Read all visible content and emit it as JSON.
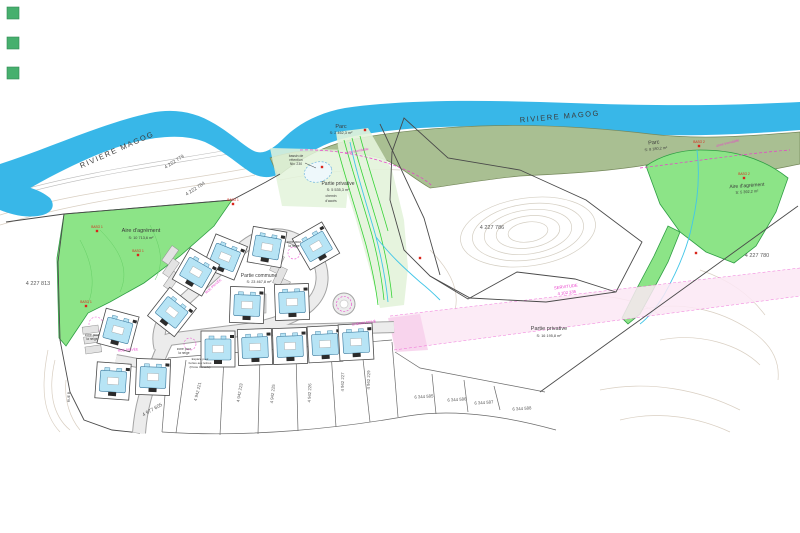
{
  "document_type": "cadastral site plan",
  "colors": {
    "river": "#38b7e8",
    "green": "#8ce487",
    "green_border": "#2f9e44",
    "green_contour": "#66cf66",
    "olive": "#a9bf92",
    "olive_border": "#75885b",
    "pale_green": "#e3f3da",
    "corridor_line": "#36d336",
    "stream": "#43c6e8",
    "road_fill": "#ececec",
    "road_edge": "#a3a3a3",
    "building": "#b7e4f5",
    "building_border": "#39789d",
    "plot_border": "#4a4a4a",
    "magenta": "#e93ecb",
    "pink_band": "#fbe7f5",
    "pink_patch": "#f7d2ec",
    "red": "#d9261c",
    "ink": "#3c3c3c",
    "dim": "#5a5a5a",
    "contour": "#d9cfc2",
    "legend_square": "#47b06e"
  },
  "legend_squares": [
    {
      "name": "swatch-1"
    },
    {
      "name": "swatch-2"
    },
    {
      "name": "swatch-3"
    }
  ],
  "map": {
    "texts": [
      {
        "id": "river-label-left",
        "t": "RIVIERE MAGOG",
        "x": 118,
        "y": 152,
        "s": 7.5,
        "r": -24,
        "c": "ink",
        "ls": 1.5
      },
      {
        "id": "river-label-right",
        "t": "RIVIERE MAGOG",
        "x": 560,
        "y": 119,
        "s": 7.5,
        "r": -5,
        "c": "ink",
        "ls": 1.5
      },
      {
        "id": "lot-4222779",
        "t": "4 222 779",
        "x": 175,
        "y": 163,
        "s": 5,
        "r": -33,
        "c": "dim"
      },
      {
        "id": "lot-4222784",
        "t": "4 222 784",
        "x": 196,
        "y": 190,
        "s": 5,
        "r": -33,
        "c": "dim"
      },
      {
        "id": "lot-4227813",
        "t": "4 227 813",
        "x": 38,
        "y": 285,
        "s": 5.5,
        "r": 0,
        "c": "dim"
      },
      {
        "id": "lot-4227786",
        "t": "4 227 786",
        "x": 492,
        "y": 229,
        "s": 5.5,
        "r": 0,
        "c": "dim"
      },
      {
        "id": "lot-4227780",
        "t": "4 227 780",
        "x": 757,
        "y": 257,
        "s": 5.5,
        "r": 0,
        "c": "dim"
      },
      {
        "id": "lot-4977605",
        "t": "4 977 605",
        "x": 153,
        "y": 411,
        "s": 5,
        "r": -30,
        "c": "dim"
      },
      {
        "id": "parc-left",
        "t": "Parc",
        "x": 341,
        "y": 128,
        "s": 5.5,
        "r": 0,
        "c": "ink"
      },
      {
        "id": "parc-left-area",
        "t": "S: 2 462,3 m²",
        "x": 341,
        "y": 134,
        "s": 3.8,
        "r": 0,
        "c": "ink"
      },
      {
        "id": "parc-right",
        "t": "Parc",
        "x": 654,
        "y": 144,
        "s": 5.5,
        "r": -6,
        "c": "ink"
      },
      {
        "id": "parc-right-area",
        "t": "S: 8 180,2 m²",
        "x": 656,
        "y": 150,
        "s": 3.8,
        "r": -6,
        "c": "ink"
      },
      {
        "id": "aire-left",
        "t": "Aire d'agrément",
        "x": 141,
        "y": 232,
        "s": 5.5,
        "r": 0,
        "c": "ink"
      },
      {
        "id": "aire-left-area",
        "t": "S: 10 713,6 m²",
        "x": 141,
        "y": 239,
        "s": 3.8,
        "r": 0,
        "c": "ink"
      },
      {
        "id": "aire-right",
        "t": "Aire d'agrément",
        "x": 747,
        "y": 187,
        "s": 5,
        "r": -4,
        "c": "ink"
      },
      {
        "id": "aire-right-area",
        "t": "S: 5 392,2 m²",
        "x": 747,
        "y": 193,
        "s": 3.8,
        "r": -4,
        "c": "ink"
      },
      {
        "id": "privative-1",
        "t": "Partie privative",
        "x": 338,
        "y": 185,
        "s": 5,
        "r": 0,
        "c": "ink"
      },
      {
        "id": "privative-1-area",
        "t": "S: 5 535,3 m²",
        "x": 338,
        "y": 191,
        "s": 3.8,
        "r": 0,
        "c": "ink"
      },
      {
        "id": "privative-2",
        "t": "Partie privative",
        "x": 549,
        "y": 330,
        "s": 5.5,
        "r": 0,
        "c": "ink"
      },
      {
        "id": "privative-2-area",
        "t": "S: 16 195,8 m²",
        "x": 549,
        "y": 337,
        "s": 3.8,
        "r": 0,
        "c": "ink"
      },
      {
        "id": "commune",
        "t": "Partie commune",
        "x": 259,
        "y": 277,
        "s": 5,
        "r": 0,
        "c": "ink"
      },
      {
        "id": "commune-area",
        "t": "S: 23 467,8 m²",
        "x": 259,
        "y": 283,
        "s": 3.8,
        "r": 0,
        "c": "ink"
      },
      {
        "id": "servitude-1",
        "t": "SERVITUDE",
        "x": 566,
        "y": 288,
        "s": 4.2,
        "r": -7,
        "c": "magenta"
      },
      {
        "id": "servitude-2",
        "t": "4 102 335",
        "x": 567,
        "y": 294,
        "s": 4.2,
        "r": -7,
        "c": "magenta"
      },
      {
        "id": "zone-inondable-1",
        "t": "zone inondable",
        "x": 357,
        "y": 152,
        "s": 3.5,
        "r": -10,
        "c": "magenta"
      },
      {
        "id": "zone-inondable-2",
        "t": "zone inondable",
        "x": 728,
        "y": 144,
        "s": 3.5,
        "r": -14,
        "c": "magenta"
      },
      {
        "id": "bassin-1",
        "t": "bassin de",
        "x": 296,
        "y": 157,
        "s": 3.4,
        "r": 0,
        "c": "ink"
      },
      {
        "id": "bassin-2",
        "t": "rétention",
        "x": 296,
        "y": 161,
        "s": 3.4,
        "r": 0,
        "c": "ink"
      },
      {
        "id": "bassin-3",
        "t": "Niv. 230",
        "x": 296,
        "y": 165,
        "s": 3.4,
        "r": 0,
        "c": "ink"
      },
      {
        "id": "chemin-acces-1",
        "t": "chemin",
        "x": 331,
        "y": 197,
        "s": 3.4,
        "r": 0,
        "c": "ink"
      },
      {
        "id": "chemin-acces-2",
        "t": "d'accès",
        "x": 331,
        "y": 202,
        "s": 3.4,
        "r": 0,
        "c": "ink"
      },
      {
        "id": "neige-1a",
        "t": "zone pour",
        "x": 92,
        "y": 336,
        "s": 3.2,
        "r": 0,
        "c": "ink"
      },
      {
        "id": "neige-1b",
        "t": "la neige",
        "x": 92,
        "y": 340,
        "s": 3.2,
        "r": 0,
        "c": "ink"
      },
      {
        "id": "neige-2a",
        "t": "zone pour",
        "x": 184,
        "y": 350,
        "s": 3.2,
        "r": 0,
        "c": "ink"
      },
      {
        "id": "neige-2b",
        "t": "la neige",
        "x": 184,
        "y": 354,
        "s": 3.2,
        "r": 0,
        "c": "ink"
      },
      {
        "id": "neige-3a",
        "t": "zone pour",
        "x": 294,
        "y": 243,
        "s": 3.2,
        "r": 0,
        "c": "ink"
      },
      {
        "id": "neige-3b",
        "t": "la neige",
        "x": 294,
        "y": 247,
        "s": 3.2,
        "r": 0,
        "c": "ink"
      },
      {
        "id": "postes-1",
        "t": "Espace pour",
        "x": 200,
        "y": 360,
        "s": 3.0,
        "r": 0,
        "c": "ink"
      },
      {
        "id": "postes-2",
        "t": "boîtes aux lettres",
        "x": 200,
        "y": 364,
        "s": 3.0,
        "r": 0,
        "c": "ink"
      },
      {
        "id": "postes-3",
        "t": "(Poste Canada)",
        "x": 200,
        "y": 368,
        "s": 3.0,
        "r": 0,
        "c": "ink"
      },
      {
        "id": "rue-1",
        "t": "RUE PRIVÉE",
        "x": 214,
        "y": 287,
        "s": 3.4,
        "r": -42,
        "c": "magenta"
      },
      {
        "id": "rue-2",
        "t": "CHEMIN PRIVÉ",
        "x": 364,
        "y": 324,
        "s": 3.4,
        "r": -8,
        "c": "magenta"
      },
      {
        "id": "rue-3",
        "t": "RUE PRIVÉE",
        "x": 128,
        "y": 351,
        "s": 3.4,
        "r": -4,
        "c": "magenta"
      },
      {
        "id": "rue-4",
        "t": "RUE B",
        "x": 70,
        "y": 397,
        "s": 3.4,
        "r": -90,
        "c": "dim"
      },
      {
        "id": "lot-b1",
        "t": "4 942 221",
        "x": 199,
        "y": 392,
        "s": 4.3,
        "r": -76,
        "c": "dim"
      },
      {
        "id": "lot-b2",
        "t": "4 942 223",
        "x": 241,
        "y": 393,
        "s": 4.3,
        "r": -80,
        "c": "dim"
      },
      {
        "id": "lot-b3",
        "t": "4 942 225",
        "x": 274,
        "y": 394,
        "s": 4.3,
        "r": -84,
        "c": "dim"
      },
      {
        "id": "lot-b4",
        "t": "4 942 226",
        "x": 311,
        "y": 393,
        "s": 4.3,
        "r": -88,
        "c": "dim"
      },
      {
        "id": "lot-b5",
        "t": "4 942 227",
        "x": 344,
        "y": 382,
        "s": 4.3,
        "r": -89,
        "c": "dim"
      },
      {
        "id": "lot-b6",
        "t": "4 942 229",
        "x": 370,
        "y": 380,
        "s": 4.3,
        "r": -89,
        "c": "dim"
      },
      {
        "id": "lot-c1",
        "t": "6 344 585",
        "x": 424,
        "y": 398,
        "s": 4.3,
        "r": -4,
        "c": "dim"
      },
      {
        "id": "lot-c2",
        "t": "6 344 586",
        "x": 457,
        "y": 401,
        "s": 4.3,
        "r": -4,
        "c": "dim"
      },
      {
        "id": "lot-c3",
        "t": "6 344 587",
        "x": 484,
        "y": 404,
        "s": 4.3,
        "r": -4,
        "c": "dim"
      },
      {
        "id": "lot-c4",
        "t": "6 344 588",
        "x": 522,
        "y": 410,
        "s": 4.3,
        "r": -4,
        "c": "dim"
      }
    ],
    "markers": [
      {
        "x": 97,
        "y": 231,
        "l": "BASO 1"
      },
      {
        "x": 138,
        "y": 255,
        "l": "BASO 1"
      },
      {
        "x": 86,
        "y": 306,
        "l": "BASO 1"
      },
      {
        "x": 233,
        "y": 204,
        "l": "BASO 1"
      },
      {
        "x": 699,
        "y": 146,
        "l": "BASO 2"
      },
      {
        "x": 744,
        "y": 178,
        "l": "BASO 2"
      },
      {
        "x": 365,
        "y": 130,
        "l": ""
      },
      {
        "x": 322,
        "y": 167,
        "l": ""
      },
      {
        "x": 420,
        "y": 258,
        "l": ""
      },
      {
        "x": 696,
        "y": 253,
        "l": ""
      }
    ],
    "buildings": [
      {
        "x": 225,
        "y": 257,
        "r": 22
      },
      {
        "x": 267,
        "y": 247,
        "r": 10
      },
      {
        "x": 316,
        "y": 246,
        "r": -30
      },
      {
        "x": 196,
        "y": 272,
        "r": 30
      },
      {
        "x": 172,
        "y": 312,
        "r": 38
      },
      {
        "x": 247,
        "y": 305,
        "r": 2
      },
      {
        "x": 292,
        "y": 302,
        "r": -2
      },
      {
        "x": 118,
        "y": 330,
        "r": 15
      },
      {
        "x": 113,
        "y": 381,
        "r": 4
      },
      {
        "x": 153,
        "y": 377,
        "r": 2
      },
      {
        "x": 218,
        "y": 349,
        "r": 0
      },
      {
        "x": 255,
        "y": 347,
        "r": -2
      },
      {
        "x": 290,
        "y": 346,
        "r": -2
      },
      {
        "x": 325,
        "y": 344,
        "r": -3
      },
      {
        "x": 356,
        "y": 342,
        "r": -3
      }
    ]
  }
}
